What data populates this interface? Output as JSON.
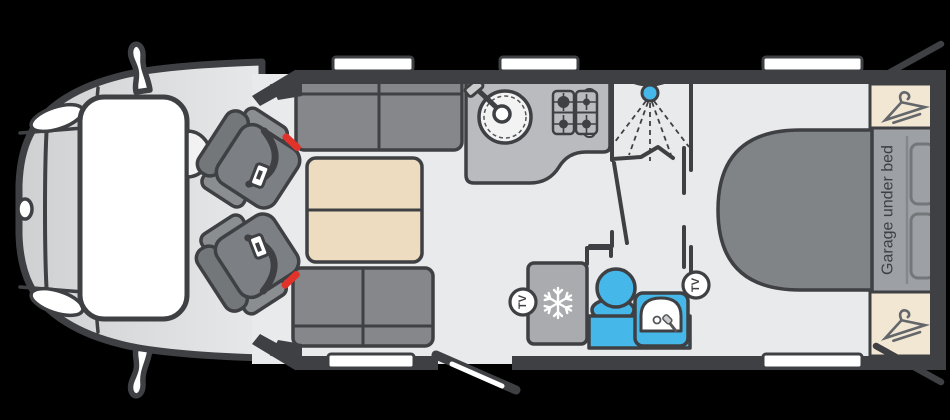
{
  "labels": {
    "garage_under_bed": "Garage under bed",
    "tv_front": "TV",
    "tv_rear": "TV"
  },
  "colors": {
    "background": "#000000",
    "outline": "#3e4043",
    "floor": "#e9eaeb",
    "accent_blue": "#45b7e8",
    "seatbelt_red": "#e23229",
    "sofa_grey": "#85878b",
    "seat_grey": "#74777a",
    "seat_light": "#8b8e91",
    "table_wood": "#eddcbf",
    "counter_grey": "#b9bbbe",
    "fridge_grey": "#a9abae",
    "bed_grey": "#818487",
    "garage_grey": "#9da0a4",
    "wardrobe_cream": "#f1e7d3",
    "cab_front": "#cfd0d2",
    "cab_rear": "#e7e8e9",
    "window_white": "#ffffff"
  },
  "icons": [
    "shower-head-icon",
    "snowflake-icon",
    "hanger-icon",
    "tv-badge-icon",
    "sink-icon",
    "hob-burner-icon",
    "seatbelt-icon",
    "wing-mirror-icon"
  ]
}
